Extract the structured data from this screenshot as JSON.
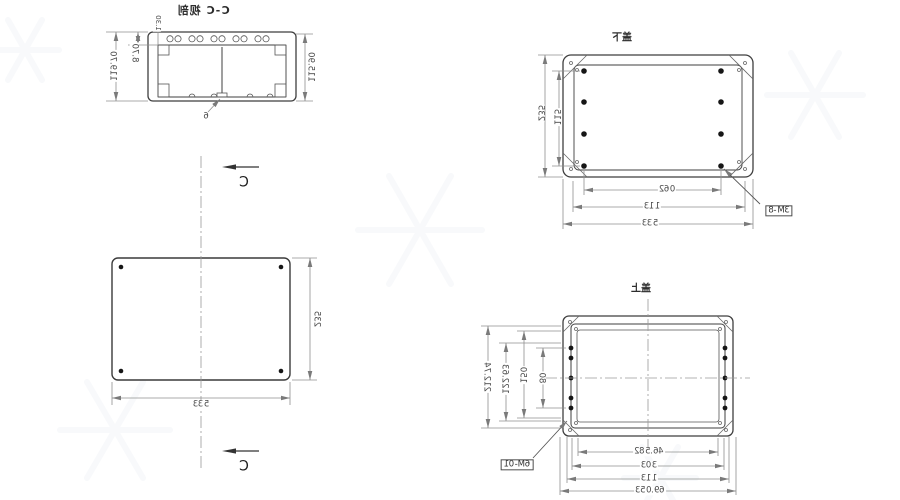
{
  "drawing": {
    "colors": {
      "geometry_line": "#3f3f3f",
      "dimension_line": "#8f8f8f",
      "background": "#ffffff"
    },
    "section_view": {
      "title": "剖视 C-C",
      "overall_height": "119.70",
      "rib_depth": "8.70",
      "lip_step": "1.30",
      "inner_height": "115.90",
      "wall_thickness": "6"
    },
    "cover_outline_view": {
      "section_label": "C",
      "width": "335",
      "height": "235"
    },
    "lower_cover_view": {
      "title": "下盖",
      "height": "235",
      "hole_row_span": "115",
      "hole_col_span": "260",
      "screw_span": "311",
      "width": "335",
      "thread_callout": "8-M3"
    },
    "upper_body_view": {
      "title": "上盖",
      "overall_depth": "212.74",
      "hole_span_a": "122.63",
      "hole_span_b": "150",
      "hole_span_c": "80",
      "inner_width": "285.64",
      "wall_span": "303",
      "screw_span": "311",
      "overall_width": "350.96",
      "thread_callout": "10-M6"
    }
  }
}
